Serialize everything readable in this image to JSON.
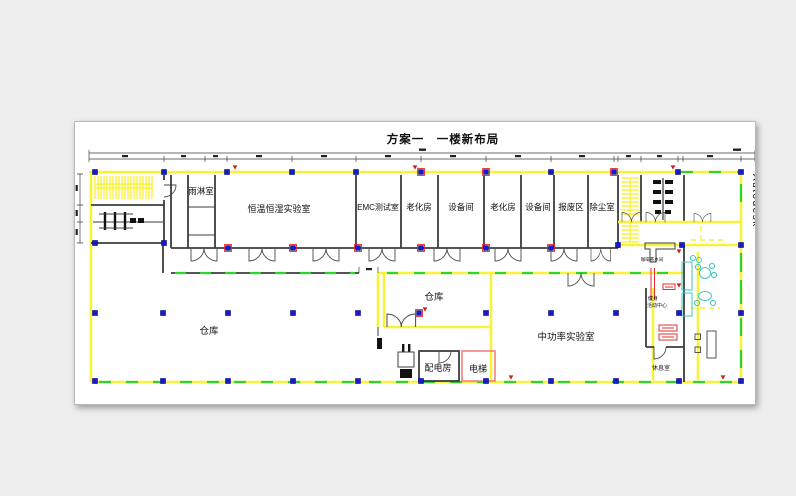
{
  "title": "方案一　一楼新布局",
  "watermark": "Autodesk",
  "rooms": {
    "rain_room": "雨淋室",
    "const_temp_humidity_lab": "恒温恒湿实验室",
    "emc_test_room": "EMC测试室",
    "aging_room_1": "老化房",
    "equipment_room_1": "设备间",
    "aging_room_2": "老化房",
    "equipment_room_2": "设备间",
    "scrap_area": "报废区",
    "dust_removal_room": "除尘室",
    "large_warehouse": "仓库",
    "small_warehouse": "仓库",
    "mid_power_lab": "中功率实验室",
    "power_distribution_room": "配电房",
    "elevator": "电梯",
    "coffee_pantry": "咖啡茶水间",
    "fitness_center_line1": "健身",
    "fitness_center_line2": "活动中心",
    "rest_room": "休息室"
  },
  "colors": {
    "page_background": "#eeeeee",
    "canvas_background": "#ffffff",
    "wall_yellow": "#f9f23a",
    "window_green": "#2fd42f",
    "column_blue": "#1a1acc",
    "column_red_outline": "#e03030",
    "furniture_cyan": "#3fc6c6",
    "elevator_red": "#f08080",
    "watermark_gray": "#9a9a9a",
    "line_dark": "#3d3d3d"
  }
}
